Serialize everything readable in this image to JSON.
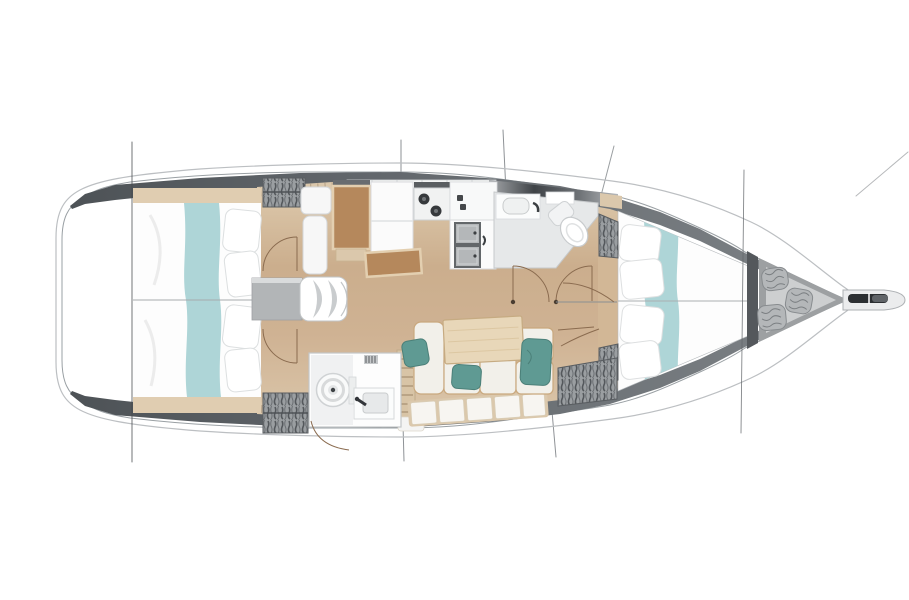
{
  "figure": {
    "type": "sailboat-interior-floor-plan",
    "view": "top-down",
    "orientation": "bow-right-stern-left"
  },
  "regions": [
    "stern-platform",
    "aft-cabin-port",
    "aft-cabin-starboard",
    "companionway-steps",
    "nav-station",
    "galley",
    "aft-head",
    "saloon-settee",
    "saloon-table",
    "forward-head",
    "forward-cabin-vberth",
    "anchor-locker",
    "bowsprit",
    "rigging-lines",
    "hull"
  ],
  "colors": {
    "background": "#ffffff",
    "hull-outline": "#9aa0a4",
    "hull-rim": "#b8bbbe",
    "hull-band-dark": "#53585c",
    "hull-band-mid": "#6e7377",
    "deck-white": "#ffffff",
    "floor-wood": "#c9ab8a",
    "floor-wood-light": "#e0cdb1",
    "trim-tan": "#dbc8ac",
    "furniture-wood": "#b5885c",
    "bed-white": "#fdfdfd",
    "runner-teal": "#aed5d7",
    "pillow-teal": "#5f9a93",
    "cushion-cream": "#f2f0ea",
    "cushion-frame": "#c9a87e",
    "locker-gray": "#9a9ea1",
    "locker-stripe": "#54585c",
    "fixture-white": "#fafbfb",
    "fixture-gray": "#e6e8e9",
    "steel-gray": "#b4b7b9",
    "steel-dark": "#2c2f32",
    "dark-detail": "#3c4043",
    "door-arc": "#8a6b4f",
    "hinge-dot": "#4a3d31",
    "rigging-gray": "#8e9296",
    "rigging-dark": "#45494d",
    "rope-gray": "#b4b7b9",
    "locker-box-gray": "#b2b5b7",
    "anchor-outer": "#9da0a2",
    "anchor-inner": "#cdcfd0"
  }
}
